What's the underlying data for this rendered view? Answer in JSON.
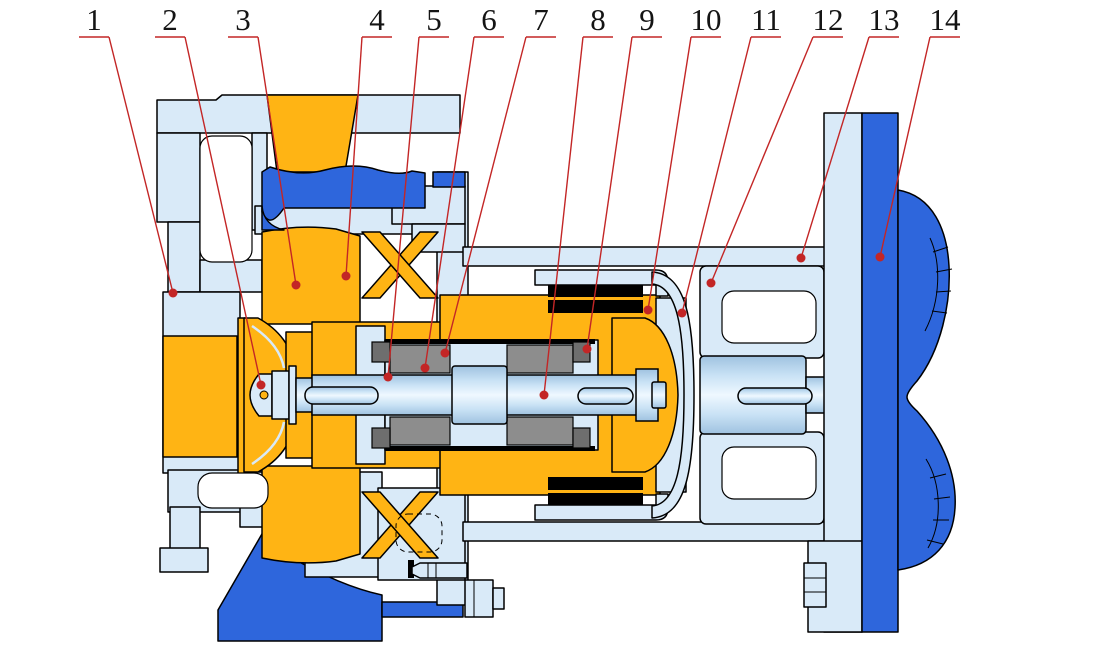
{
  "figure": {
    "width": 1100,
    "height": 650,
    "background": "#FFFFFF",
    "type": "pump-cross-section-diagram"
  },
  "colors": {
    "bg": "#FFFFFF",
    "metal": "#D9EAF8",
    "orange": "#FFB414",
    "blue": "#2E66DC",
    "gray": "#8D8D8D",
    "darkgray": "#6E6E6E",
    "magnet": "#000000",
    "line": "#000000",
    "leader": "#C32626"
  },
  "callouts": [
    {
      "n": "1",
      "x": 94,
      "side": "right",
      "dot": [
        173,
        293
      ]
    },
    {
      "n": "2",
      "x": 170,
      "side": "right",
      "dot": [
        261,
        385
      ]
    },
    {
      "n": "3",
      "x": 243,
      "side": "right",
      "dot": [
        296,
        285
      ]
    },
    {
      "n": "4",
      "x": 377,
      "side": "left",
      "dot": [
        346,
        276
      ]
    },
    {
      "n": "5",
      "x": 434,
      "side": "left",
      "dot": [
        388,
        377
      ]
    },
    {
      "n": "6",
      "x": 489,
      "side": "left",
      "dot": [
        425,
        368
      ]
    },
    {
      "n": "7",
      "x": 541,
      "side": "left",
      "dot": [
        445,
        353
      ]
    },
    {
      "n": "8",
      "x": 598,
      "side": "left",
      "dot": [
        544,
        395
      ]
    },
    {
      "n": "9",
      "x": 647,
      "side": "left",
      "dot": [
        587,
        349
      ]
    },
    {
      "n": "10",
      "x": 706,
      "side": "left",
      "dot": [
        648,
        310
      ]
    },
    {
      "n": "11",
      "x": 766,
      "side": "left",
      "dot": [
        682,
        313
      ]
    },
    {
      "n": "12",
      "x": 828,
      "side": "left",
      "dot": [
        711,
        283
      ]
    },
    {
      "n": "13",
      "x": 884,
      "side": "left",
      "dot": [
        801,
        258
      ]
    },
    {
      "n": "14",
      "x": 945,
      "side": "left",
      "dot": [
        880,
        257
      ]
    }
  ]
}
